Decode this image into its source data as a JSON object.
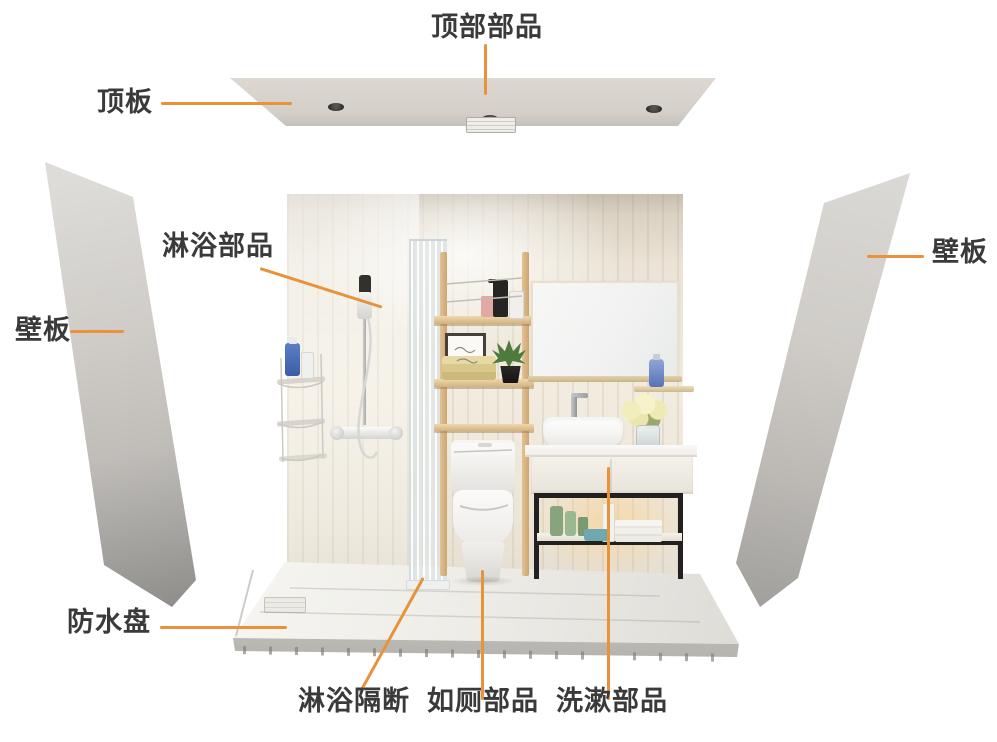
{
  "figure": {
    "kind": "exploded assembly diagram of a prefabricated unit bathroom"
  },
  "labels": {
    "top_parts": "顶部部品",
    "ceiling_panel": "顶板",
    "wall_panel_left": "壁板",
    "shower_parts": "淋浴部品",
    "wall_panel_right": "壁板",
    "waterproof_pan": "防水盘",
    "shower_partition": "淋浴隔断",
    "toilet_parts": "如厕部品",
    "washing_parts": "洗漱部品"
  },
  "colors": {
    "leader_line": "#E8923A",
    "label_text": "#3A3A3A",
    "panel_gray": "#C9C6C2",
    "wood": "#D9B483",
    "background": "#FFFFFF"
  }
}
